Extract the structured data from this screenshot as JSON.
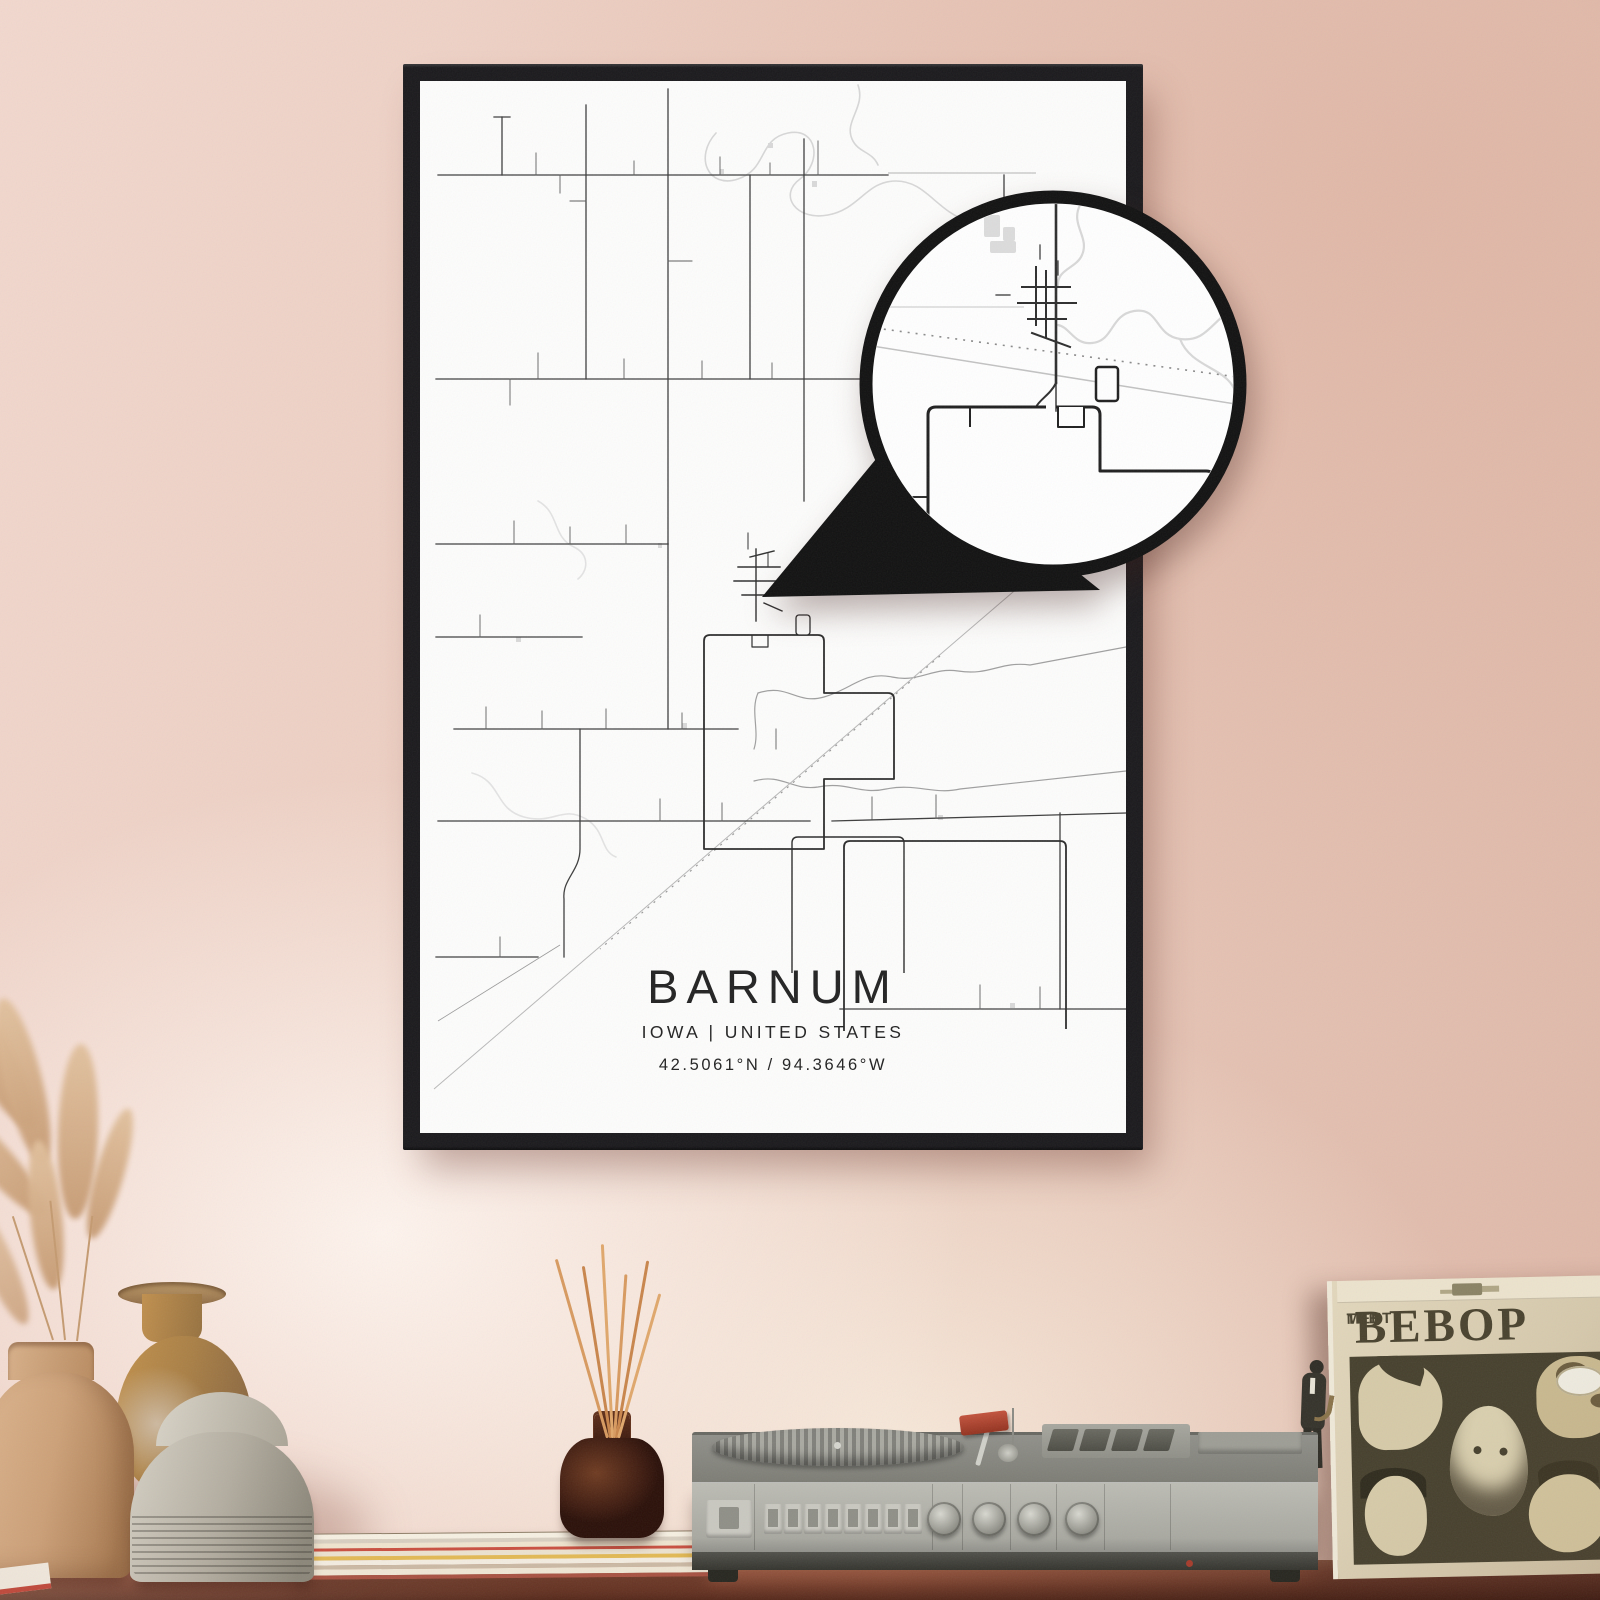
{
  "poster": {
    "title": "BARNUM",
    "subtitle": "IOWA | UNITED STATES",
    "coordinates": "42.5061°N / 94.3646°W",
    "frame_color": "#1a191c",
    "paper_color": "#fdfdfc",
    "text_color": "#222222",
    "map": {
      "road_color": "#3d3d3d",
      "minor_road_color": "#5c5c5c",
      "faint_road_color": "#9a9a9a",
      "town_outline_color": "#2b2b2b",
      "river_color": "#d7d7d7",
      "stream_color": "#9f9f9f",
      "railroad_color": "#b8b8b8",
      "building_color": "#d9d9d9"
    }
  },
  "magnifier": {
    "ring_color": "#111111",
    "paper_color": "#ffffff"
  },
  "album": {
    "title_small_1": "MEET",
    "title_small_2": "THE",
    "title_main": "BEBOP",
    "cover_color": "#d9cdb2",
    "ink_color": "#4a4330"
  },
  "wall": {
    "base_color": "#ecccbf",
    "highlight_color": "#fdf3ec",
    "shadow_color": "#deb7a7"
  },
  "shelf": {
    "wood_color": "#8d4f3a"
  }
}
